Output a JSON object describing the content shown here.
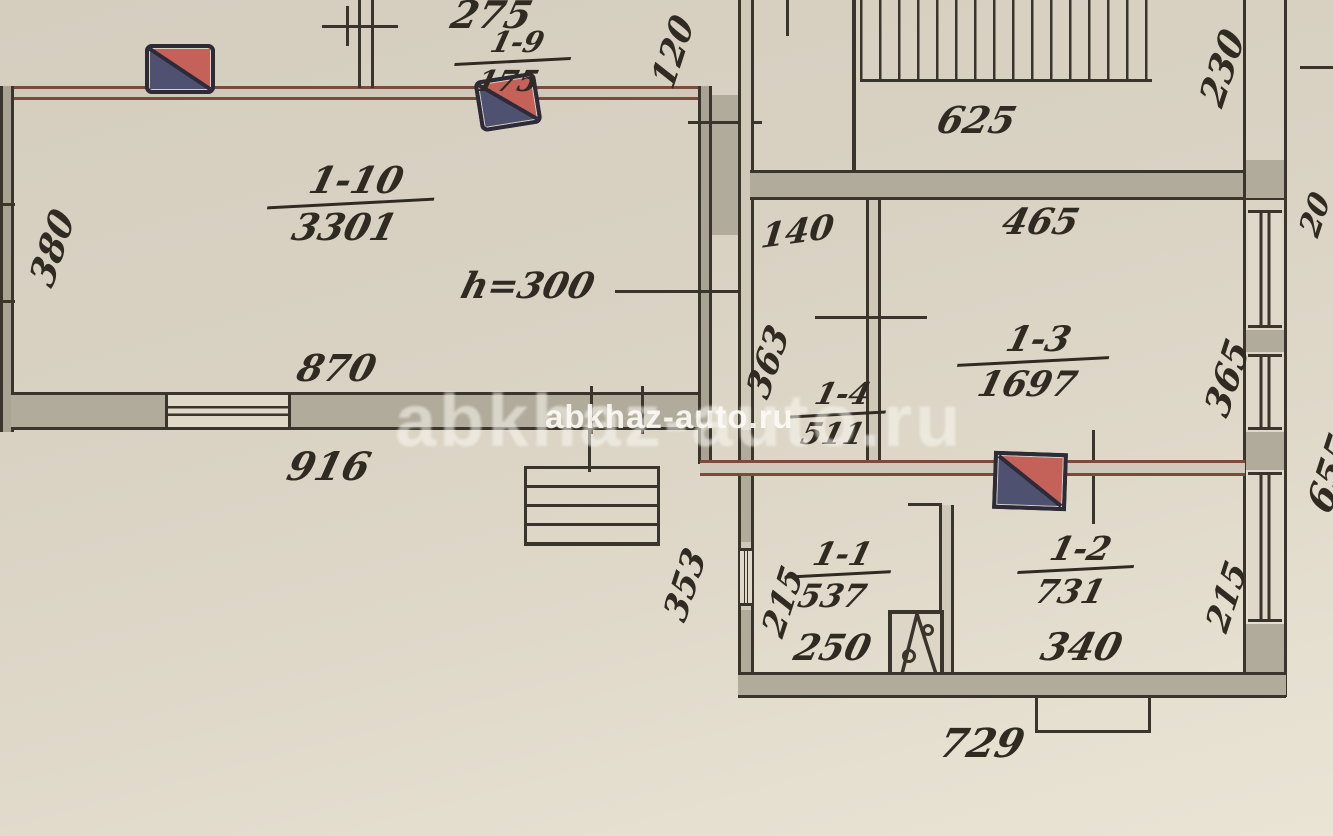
{
  "watermark": {
    "large": "abkhaz-auto.ru",
    "small": "abkhaz-auto.ru"
  },
  "colors": {
    "paper": "#d9d2c3",
    "wall_fill": "#b1ab9b",
    "ink_line": "#3a352c",
    "brown_wall": "#7c4a38",
    "stove_red": "#c4625a",
    "stove_blue": "#4e5270",
    "handwriting": "#2f2a22"
  },
  "rooms": {
    "r110": {
      "number": "1-10",
      "area": "3301"
    },
    "r19": {
      "number": "1-9",
      "area": "175"
    },
    "r13": {
      "number": "1-3",
      "area": "1697"
    },
    "r14": {
      "number": "1-4",
      "area": "511"
    },
    "r11": {
      "number": "1-1",
      "area": "537"
    },
    "r12": {
      "number": "1-2",
      "area": "731"
    }
  },
  "notes": {
    "ceiling_height": "h=300"
  },
  "dimensions": {
    "d275": "275",
    "d120": "120",
    "d625": "625",
    "d230": "230",
    "d20": "20",
    "d140": "140",
    "d465": "465",
    "d363": "363",
    "d365": "365",
    "d655": "655",
    "d380": "380",
    "d870": "870",
    "d916": "916",
    "d353": "353",
    "d215l": "215",
    "d215r": "215",
    "d250": "250",
    "d340": "340",
    "d729": "729"
  }
}
